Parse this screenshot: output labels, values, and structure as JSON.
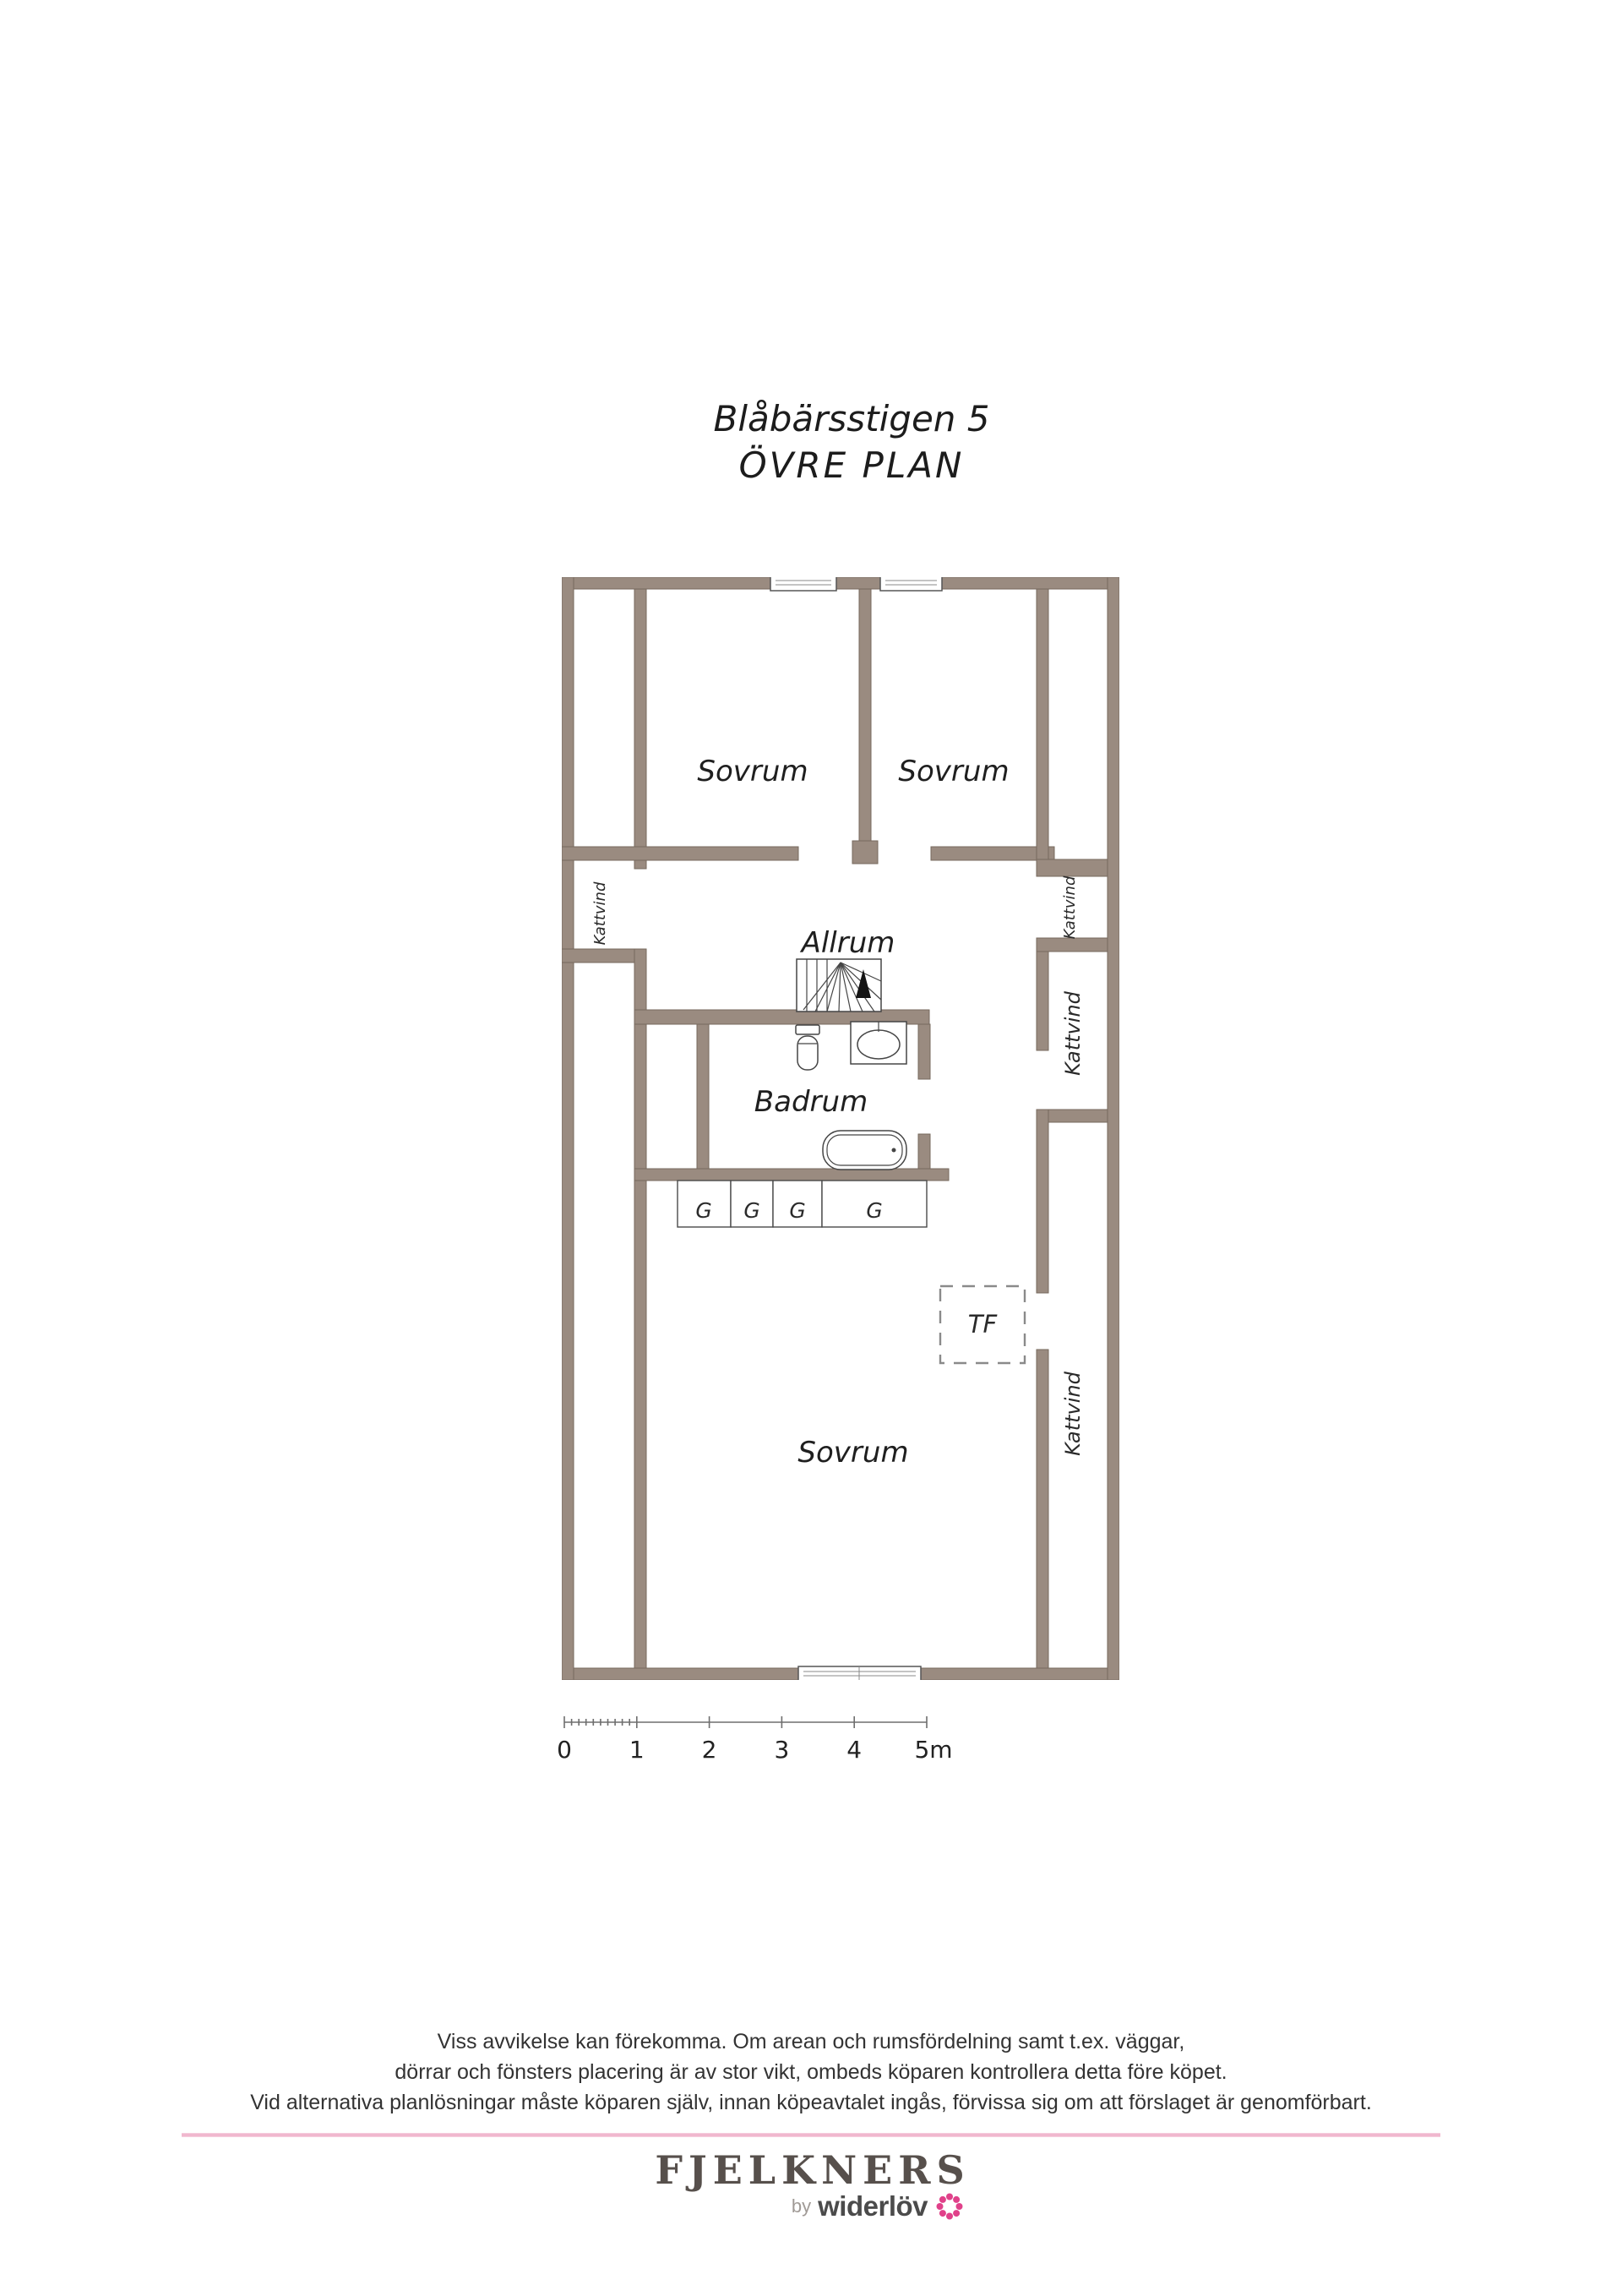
{
  "title": {
    "line1": "Blåbärsstigen 5",
    "line2": "ÖVRE PLAN"
  },
  "plan": {
    "rooms": {
      "sovrum_top_left": "Sovrum",
      "sovrum_top_right": "Sovrum",
      "allrum": "Allrum",
      "badrum": "Badrum",
      "sovrum_bottom": "Sovrum",
      "tf": "TF"
    },
    "kattvind_labels": [
      "Kattvind",
      "Kattvind",
      "Kattvind",
      "Kattvind"
    ],
    "closets": [
      "G",
      "G",
      "G",
      "G"
    ],
    "colors": {
      "wall": "#9a8b80",
      "wall_outline": "#77695e",
      "sketch": "#454545"
    }
  },
  "scale_bar": {
    "labels": [
      "0",
      "1",
      "2",
      "3",
      "4",
      "5m"
    ]
  },
  "disclaimer": {
    "line1": "Viss avvikelse kan förekomma. Om arean och rumsfördelning samt t.ex. väggar,",
    "line2": "dörrar och fönsters placering är av stor vikt, ombeds köparen kontrollera detta före köpet.",
    "line3": "Vid alternativa planlösningar måste köparen själv, innan köpeavtalet ingås, förvissa sig om att förslaget är genomförbart."
  },
  "footer": {
    "brand": "FJELKNERS",
    "by": "by",
    "sub_brand": "widerlöv",
    "brand_color": "#57504c",
    "divider_color": "#eeadc7",
    "flower_color": "#e0418a"
  }
}
